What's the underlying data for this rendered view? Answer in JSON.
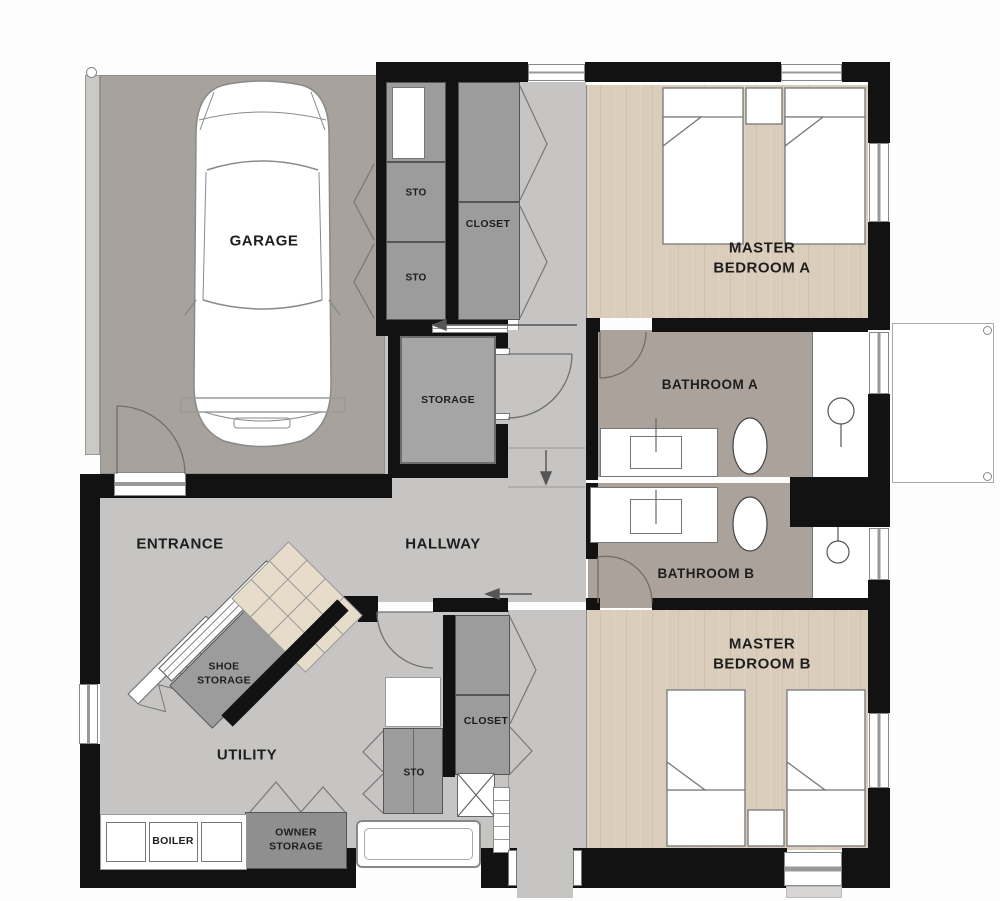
{
  "plan": {
    "type": "architectural-floor-plan",
    "rooms": {
      "garage": {
        "label": "GARAGE"
      },
      "sto_top_a": {
        "label": "STO"
      },
      "sto_top_b": {
        "label": "STO"
      },
      "closet_top": {
        "label": "CLOSET"
      },
      "master_bedroom_a": {
        "label_line1": "MASTER",
        "label_line2": "BEDROOM A"
      },
      "storage": {
        "label": "STORAGE"
      },
      "bathroom_a": {
        "label": "BATHROOM A"
      },
      "entrance": {
        "label": "ENTRANCE"
      },
      "hallway": {
        "label": "HALLWAY"
      },
      "bathroom_b": {
        "label": "BATHROOM B"
      },
      "shoe_storage": {
        "label_line1": "SHOE",
        "label_line2": "STORAGE"
      },
      "master_bedroom_b": {
        "label_line1": "MASTER",
        "label_line2": "BEDROOM B"
      },
      "closet_bottom": {
        "label": "CLOSET"
      },
      "sto_bottom": {
        "label": "STO"
      },
      "utility": {
        "label": "UTILITY"
      },
      "boiler": {
        "label": "BOILER"
      },
      "owner_storage": {
        "label_line1": "OWNER",
        "label_line2": "STORAGE"
      }
    },
    "colors": {
      "wall": "#121212",
      "garage_floor": "#a7a29c",
      "hall_floor": "#c6c5c4",
      "bedroom_floor": "#dacdbb",
      "bathroom_floor": "#aaa29b",
      "cabinet": "#9c9c9c",
      "cabinet_dark": "#8f8f8f",
      "stair_tread": "#e7dcca",
      "outline": "#555555"
    }
  }
}
